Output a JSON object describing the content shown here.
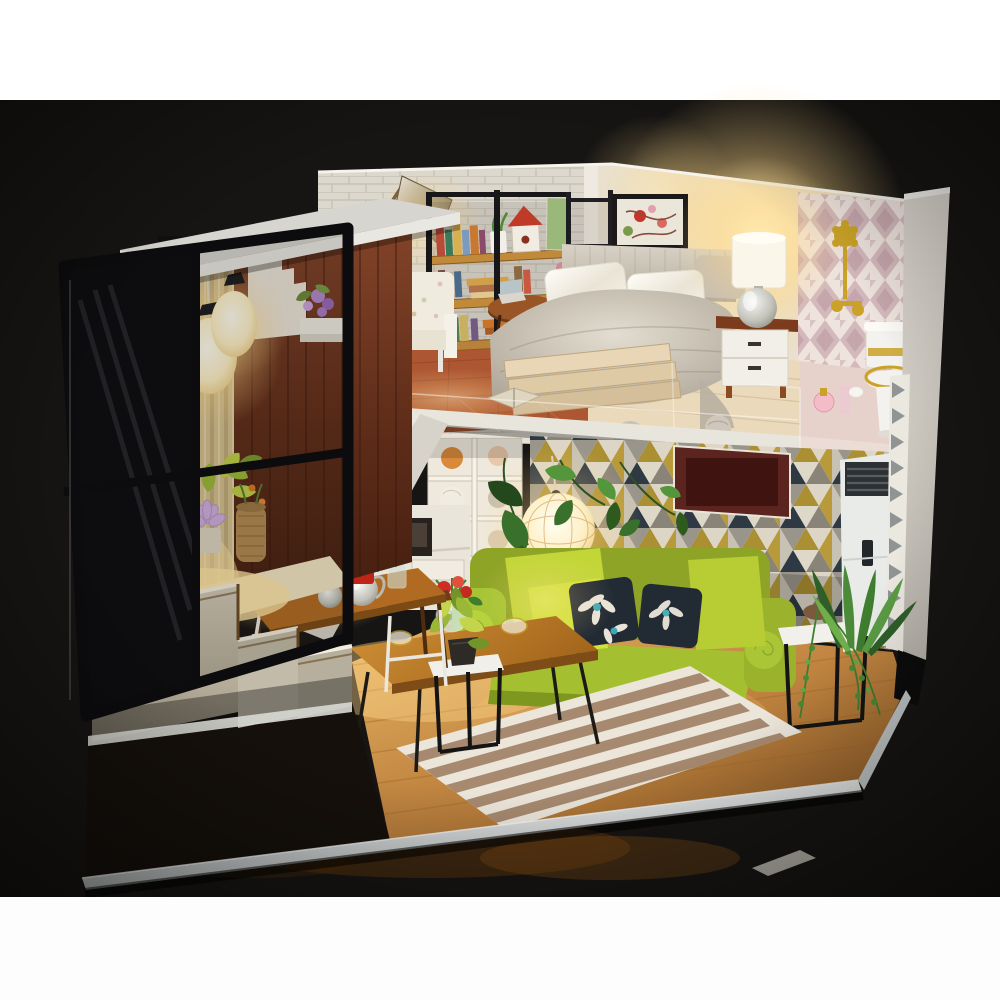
{
  "meta": {
    "kind": "photograph",
    "caption": "DIY miniature dollhouse loft apartment diorama with LED lighting, photographed on a black table with white borders"
  },
  "labels": {
    "milk_can": "MILK"
  },
  "colors": {
    "band_white": "#fdfdfd",
    "backdrop": "#171513",
    "wall": "#e6e1d7",
    "roof": "#d6d5d0",
    "wood_wall": "#6e3420",
    "curtain": "#d5c294",
    "stair_yellow": "#e8a41d",
    "floor_wood": "#c08040",
    "mezzanine_floor": "#ead9ba",
    "study_floor_brick": "#ad5632",
    "fascia": "#e8e5dc",
    "sofa_green": "#a4c030",
    "sofa_lime": "#d2e23c",
    "pillow_navy": "#222a34",
    "rug_cream": "#ebe5da",
    "rug_brown": "#9a7a5c",
    "table_wood": "#b06a22",
    "gold": "#c9a227",
    "porcelain": "#f4f2ee",
    "ac_white": "#e9ebe9",
    "milk_red": "#c02418",
    "glow_warm": "#ffdf9e",
    "harlequin_pink": "#c9abb0",
    "triangle_olive": "#ab8f33",
    "triangle_navy": "#303a46",
    "plant_green": "#3f7d2f"
  },
  "scene": {
    "areas": [
      {
        "name": "balcony-tower",
        "items": [
          "glass window wall",
          "black window frame",
          "striped curtain",
          "two glowing pendant lamps",
          "dark wood plank wall",
          "white paper wall decor",
          "purple flower shelf",
          "lotus flower planters",
          "red flowers",
          "rope vase",
          "stepped concrete base",
          "white roof slab"
        ]
      },
      {
        "name": "loft-study",
        "items": [
          "white brick wall",
          "framed tree picture",
          "bronze floor lamp",
          "floral armchair",
          "round side table",
          "laptop",
          "pink desk chair",
          "wood bookshelf with books",
          "white plant pot",
          "red birdhouse",
          "black loft railing",
          "brick tile floor"
        ]
      },
      {
        "name": "loft-bedroom",
        "items": [
          "abstract wall art",
          "double bed",
          "gray knit duvet",
          "white satin pillows",
          "plank footboard",
          "open book",
          "knit poufs",
          "white nightstand",
          "silver table lamp with glowing shade"
        ]
      },
      {
        "name": "loft-bathroom",
        "items": [
          "pink harlequin wallpaper",
          "gold shower fixture",
          "white toilet with gold trim",
          "pink perfume bottles"
        ]
      },
      {
        "name": "living-room",
        "items": [
          "triangle pattern wallpaper",
          "green fabric sofa",
          "lime cushions",
          "black floral pillows",
          "striped rug",
          "wood coffee table",
          "flower vase",
          "glass bowls",
          "glowing rattan ball pendant",
          "hanging vine leaves",
          "white cube side tables",
          "trailing plant",
          "leafy corner plant",
          "standing air conditioner"
        ]
      },
      {
        "name": "dining-kitchen",
        "items": [
          "wood dining table",
          "two white stools",
          "silver kettles",
          "red MILK canister with flower bouquet",
          "under-stair kitchen cabinets",
          "oven",
          "cubby shelf with yarn balls",
          "yellow-tread staircase"
        ]
      }
    ]
  }
}
